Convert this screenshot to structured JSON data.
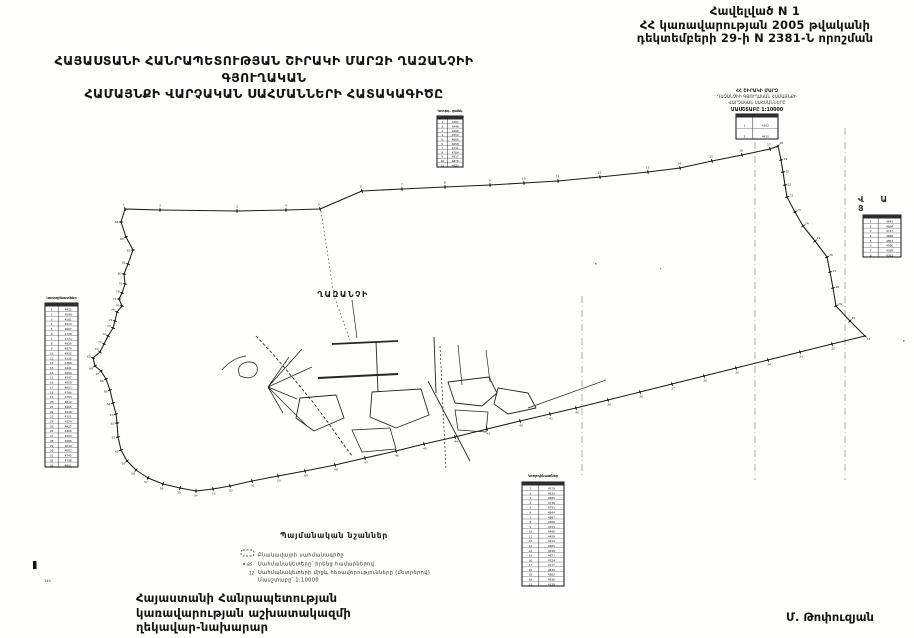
{
  "header": {
    "line1": "Հավելված N 1",
    "line2": "ՀՀ կառավարության 2005 թվականի",
    "line3": "դեկտեմբերի 29-ի N 2381-Ն որոշման"
  },
  "title": {
    "line1": "ՀԱՅԱՍՏԱՆԻ ՀԱՆՐԱՊԵՏՈՒԹՅԱՆ ՇԻՐԱԿԻ ՄԱՐԶԻ ՂԱԶԱՆՉԻԻ ԳՅՈՒՂԱԿԱՆ",
    "line2": "ՀԱՄԱՅՆՔԻ ՎԱՐՉԱԿԱՆ ՍԱՀՄԱՆՆԵՐԻ ՀԱՏԱԿԱԳԻԾԸ"
  },
  "map": {
    "settlement_label": "ՂԱԶԱՆՉԻ",
    "neighbor_letters": {
      "text": "Վ Ա Յ"
    },
    "ink_color": "#1b1b1b",
    "grid_color": "#8a8a8a",
    "boundary": [
      [
        125,
        209
      ],
      [
        160,
        210
      ],
      [
        237,
        211
      ],
      [
        286,
        210
      ],
      [
        320,
        209
      ],
      [
        362,
        191
      ],
      [
        402,
        189
      ],
      [
        445,
        187
      ],
      [
        490,
        185
      ],
      [
        524,
        183
      ],
      [
        558,
        181
      ],
      [
        600,
        177
      ],
      [
        648,
        172
      ],
      [
        680,
        168
      ],
      [
        712,
        161
      ],
      [
        742,
        155
      ],
      [
        770,
        149
      ],
      [
        778,
        146
      ],
      [
        781,
        160
      ],
      [
        783,
        172
      ],
      [
        785,
        185
      ],
      [
        787,
        197
      ],
      [
        795,
        212
      ],
      [
        803,
        226
      ],
      [
        815,
        241
      ],
      [
        827,
        257
      ],
      [
        830,
        272
      ],
      [
        833,
        288
      ],
      [
        836,
        306
      ],
      [
        850,
        321
      ],
      [
        865,
        336
      ],
      [
        832,
        344
      ],
      [
        800,
        352
      ],
      [
        768,
        360
      ],
      [
        736,
        368
      ],
      [
        704,
        376
      ],
      [
        672,
        384
      ],
      [
        640,
        392
      ],
      [
        608,
        400
      ],
      [
        576,
        408
      ],
      [
        550,
        414
      ],
      [
        520,
        421
      ],
      [
        487,
        429
      ],
      [
        455,
        437
      ],
      [
        424,
        444
      ],
      [
        396,
        451
      ],
      [
        365,
        458
      ],
      [
        335,
        465
      ],
      [
        305,
        471
      ],
      [
        278,
        476
      ],
      [
        252,
        481
      ],
      [
        230,
        486
      ],
      [
        213,
        489
      ],
      [
        196,
        491
      ],
      [
        180,
        488
      ],
      [
        163,
        484
      ],
      [
        148,
        478
      ],
      [
        136,
        470
      ],
      [
        127,
        461
      ],
      [
        121,
        450
      ],
      [
        118,
        437
      ],
      [
        117,
        423
      ],
      [
        116,
        414
      ],
      [
        113,
        403
      ],
      [
        110,
        390
      ],
      [
        106,
        379
      ],
      [
        101,
        371
      ],
      [
        95,
        366
      ],
      [
        93,
        358
      ],
      [
        100,
        352
      ],
      [
        104,
        344
      ],
      [
        108,
        336
      ],
      [
        113,
        328
      ],
      [
        115,
        321
      ],
      [
        117,
        312
      ],
      [
        122,
        306
      ],
      [
        119,
        299
      ],
      [
        122,
        293
      ],
      [
        125,
        284
      ],
      [
        124,
        274
      ],
      [
        128,
        264
      ],
      [
        133,
        250
      ],
      [
        126,
        237
      ],
      [
        121,
        222
      ]
    ],
    "grid_lines": [
      {
        "x": 582,
        "y1": 296,
        "y2": 476
      },
      {
        "x": 755,
        "y1": 128,
        "y2": 480
      },
      {
        "x": 845,
        "y1": 128,
        "y2": 480
      }
    ],
    "village_paths": [
      {
        "d": "M321,211 L334,296 L350,340",
        "w": 0.6,
        "dash": "1.5 2.5"
      },
      {
        "d": "M256,336 L271,352 L284,367 L298,384 L312,401 L327,421 L341,441 L352,456",
        "w": 0.9,
        "dash": "3 2"
      },
      {
        "d": "M268,387 L302,349 M268,387 L289,357 M268,387 L312,367 M268,387 L297,399 M268,387 L283,413 M268,387 L307,426",
        "w": 0.8
      },
      {
        "d": "M240,376 Q235,365 247,362 Q259,361 257,372 Q253,381 240,376",
        "w": 0.8
      },
      {
        "d": "M222,370 Q232,358 246,356",
        "w": 0.7
      },
      {
        "d": "M318,378 L398,374",
        "w": 2
      },
      {
        "d": "M332,344 L398,341",
        "w": 1.8
      },
      {
        "d": "M376,341 L378,392",
        "w": 0.9
      },
      {
        "d": "M434,337 L436,393",
        "w": 0.9
      },
      {
        "d": "M352,300 L357,338",
        "w": 0.7
      },
      {
        "d": "M300,398 L336,395 L344,418 L314,431 L296,418 Z",
        "w": 0.9
      },
      {
        "d": "M372,392 L421,389 L429,415 L396,428 L370,417 Z",
        "w": 0.9
      },
      {
        "d": "M448,382 L489,377 L497,393 L482,406 L455,403 Z",
        "w": 0.9
      },
      {
        "d": "M498,388 L528,393 L536,408 L508,414 L494,404 Z",
        "w": 0.9
      },
      {
        "d": "M455,410 L488,412 L486,432 L458,430 Z",
        "w": 0.8
      },
      {
        "d": "M352,430 L390,428 L396,449 L362,452 Z",
        "w": 0.8
      },
      {
        "d": "M428,381 L470,461",
        "w": 0.9
      },
      {
        "d": "M440,346 L446,470",
        "w": 0.7,
        "dash": "2 2"
      },
      {
        "d": "M528,408 L606,380",
        "w": 0.7
      },
      {
        "d": "M458,345 L462,385 M486,350 L490,382",
        "w": 0.7
      }
    ],
    "tables": [
      {
        "id": "coordinate-table-top",
        "x": 437,
        "y": 116,
        "w": 26,
        "h": 51,
        "rows": 11,
        "cols": 2,
        "seed": 3,
        "header": "Կոորդ. ցանկ",
        "header_y": 112
      },
      {
        "id": "coordinate-table-left",
        "x": 45,
        "y": 303,
        "w": 33,
        "h": 164,
        "rows": 33,
        "cols": 2,
        "seed": 5,
        "header": "Կոորդինատներ",
        "header_y": 299
      },
      {
        "id": "coordinate-table-bottom",
        "x": 522,
        "y": 482,
        "w": 42,
        "h": 104,
        "rows": 21,
        "cols": 2,
        "seed": 9,
        "header": "Կոորդինատներ",
        "header_y": 477
      },
      {
        "id": "coordinate-table-right",
        "x": 863,
        "y": 215,
        "w": 38,
        "h": 42,
        "rows": 8,
        "cols": 2,
        "seed": 11,
        "header": "",
        "header_y": 0
      },
      {
        "id": "stamp-table",
        "x": 736,
        "y": 114,
        "w": 42,
        "h": 25,
        "rows": 2,
        "cols": 2,
        "seed": 2,
        "header": "",
        "header_y": 0
      }
    ],
    "corner_mark": {
      "label": "140"
    }
  },
  "stamp": {
    "line1": "ՀՀ ՇԻՐԱԿԻ ՄԱՐԶ",
    "line2": "ՂԱԶԱՆՉԻԻ ԳՅՈՒՂԱԿԱՆ ՀԱՄԱՅՆՔԻ",
    "line3": "ՎԱՐՉԱԿԱՆ ՍԱՀՄԱՆՆԵՐԸ",
    "line4": "ՄԱՍՇՏԱԲԸ 1:10000"
  },
  "legend": {
    "title": "Պայմանական նշաններ",
    "items": [
      {
        "marker": "dashed-box",
        "text": "Բնակավայրի սահմանագիծը"
      },
      {
        "marker": "95",
        "text": "Սահմանակետերը՝ իրենց համարներով"
      },
      {
        "marker": "12",
        "text": "Սահմանակետերի միջև հեռավորությունները (մետրերով)"
      },
      {
        "marker": "",
        "text": "Մասշտաբը՝ 1:10000"
      }
    ]
  },
  "signature": {
    "line1": "Հայաստանի Հանրապետության",
    "line2": "կառավարության աշխատակազմի",
    "line3": "ղեկավար-նախարար",
    "name": "Մ. Թոփուզյան"
  }
}
